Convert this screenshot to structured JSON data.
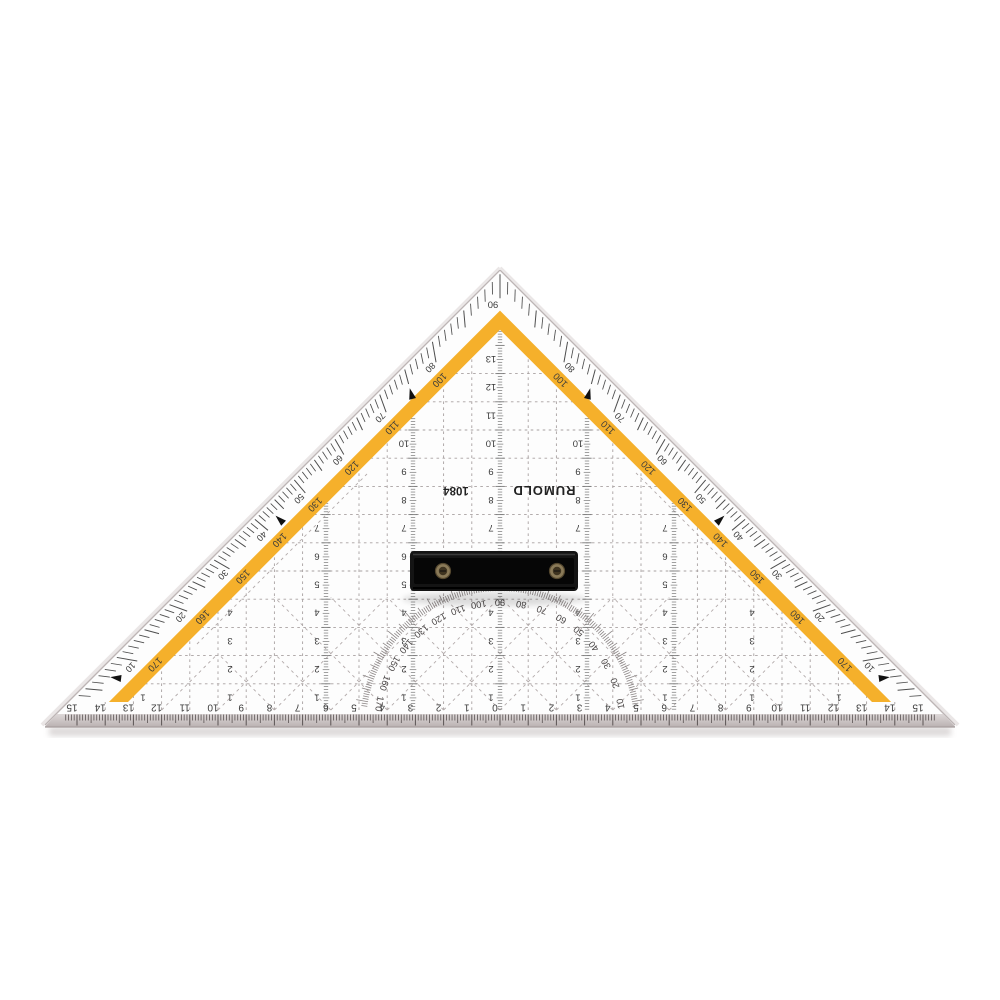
{
  "title": "Transparent geometry set square with handle (product photo, printing shown flipped 180°)",
  "product": {
    "brand": "RUMOLD",
    "model": "1084"
  },
  "apex_degree_label": "90",
  "hypotenuse_degree_pairs": [
    [
      100,
      80
    ],
    [
      110,
      70
    ],
    [
      120,
      60
    ],
    [
      130,
      50
    ],
    [
      140,
      40
    ],
    [
      150,
      30
    ],
    [
      160,
      20
    ],
    [
      170,
      10
    ]
  ],
  "protractor_degree_labels": [
    10,
    20,
    30,
    40,
    50,
    60,
    70,
    80,
    90,
    100,
    110,
    120,
    130,
    140,
    150,
    160,
    170
  ],
  "bottom_scale": {
    "left_labels": [
      15,
      14,
      13,
      12,
      11,
      10,
      9,
      8,
      7,
      6,
      5,
      4,
      3,
      2,
      1
    ],
    "center_label": "0",
    "right_labels": [
      1,
      2,
      3,
      4,
      5,
      6,
      7,
      8,
      9,
      10,
      11,
      12,
      13,
      14,
      15
    ]
  },
  "grid_row_labels": [
    1,
    2,
    3,
    4,
    5,
    6,
    7,
    8,
    9,
    10,
    11,
    12,
    13,
    14
  ],
  "colors": {
    "background": "#ffffff",
    "body_plastic": "#fdfdfd",
    "stripe_yellow": "#F5B02B",
    "ink": "#3b3b3b",
    "ink_dark": "#222222",
    "grid_gray": "#a8a1a1",
    "tick_gray": "#4d4d4d",
    "bevel_light": "#ded8d8",
    "bevel_dark": "#bbb3b3",
    "shadow": "#9d9393",
    "handle_black": "#141414",
    "screw_bronze": "#8a7a58"
  }
}
